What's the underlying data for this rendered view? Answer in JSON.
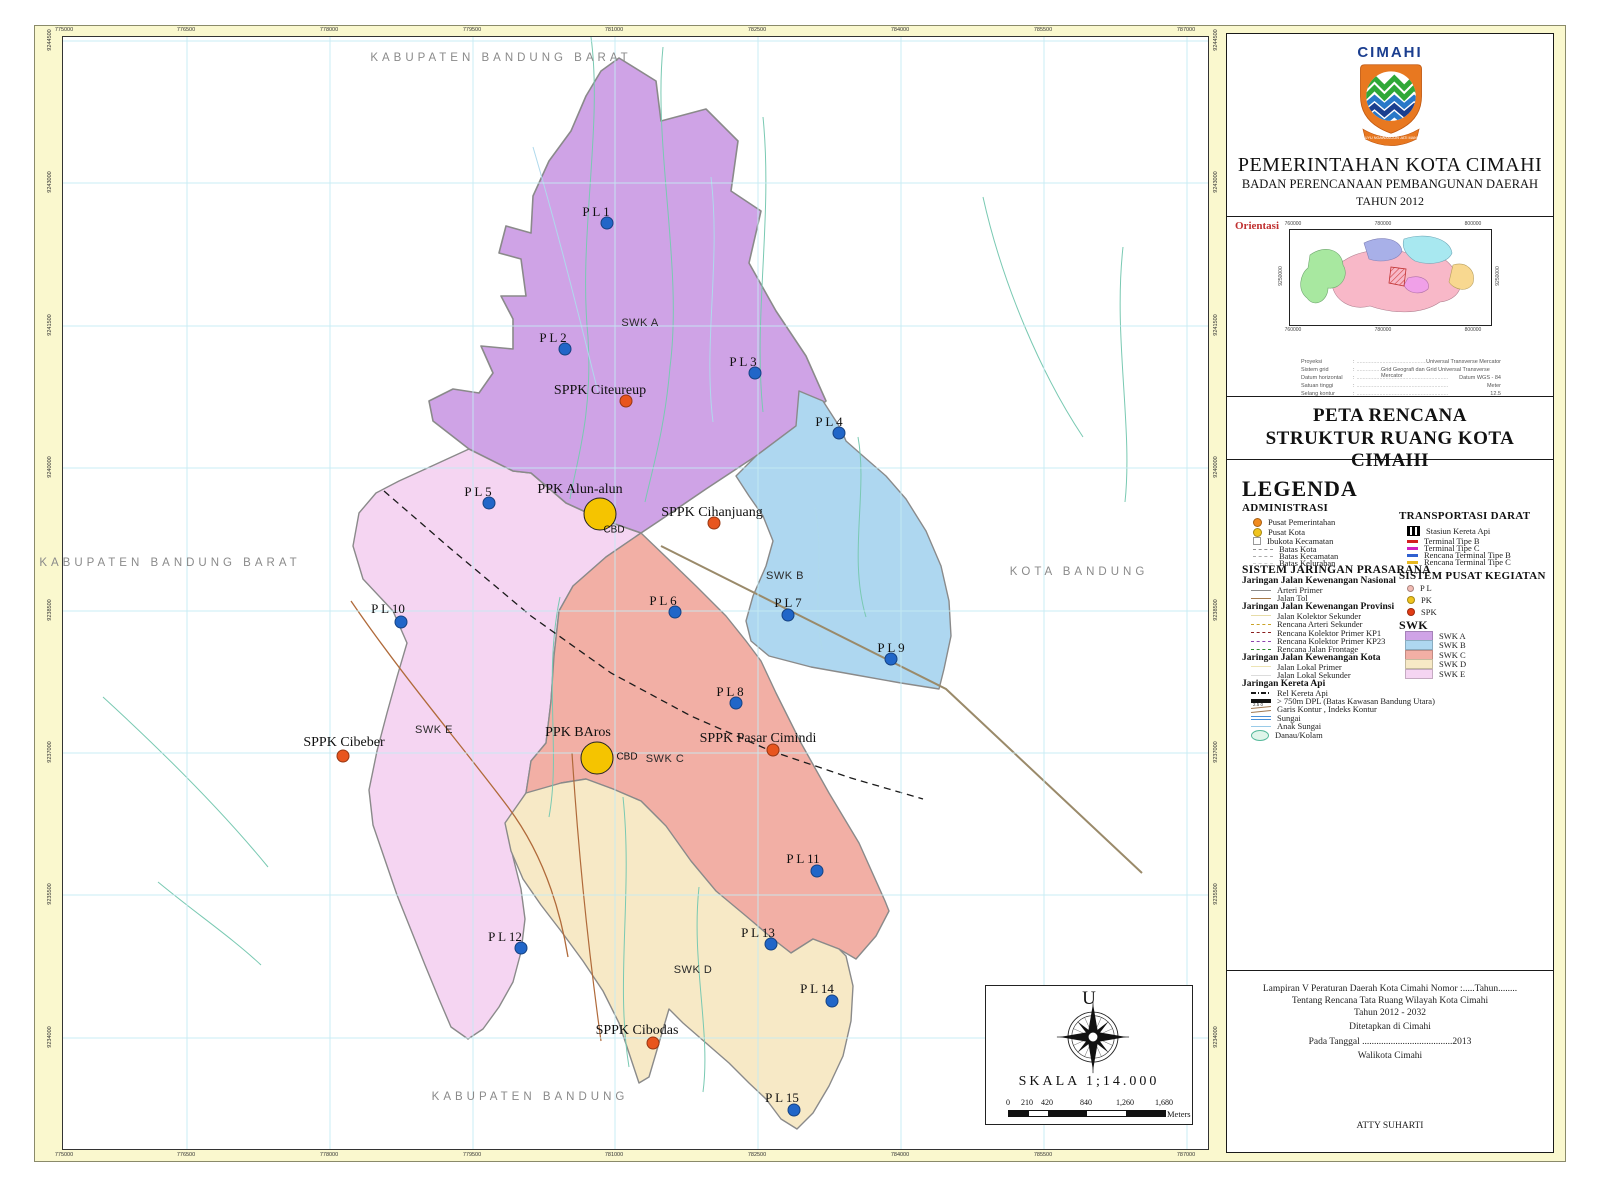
{
  "header": {
    "logo_text": "CIMAHI",
    "logo_motto": "SALUYU NGAWANGUN JATI MANDIRI",
    "agency_line1": "PEMERINTAHAN KOTA CIMAHI",
    "agency_line2": "BADAN PERENCANAAN PEMBANGUNAN DAERAH",
    "agency_line3": "TAHUN 2012"
  },
  "orientasi": {
    "label": "Orientasi",
    "grid_top": [
      "760000",
      "780000",
      "800000"
    ],
    "grid_side": "9250000",
    "projection_rows": [
      {
        "label": "Proyeksi",
        "value": "Universal Transverse Mercator"
      },
      {
        "label": "Sistem grid",
        "value": "Grid Geografi dan Grid Universal Transverse Mercator"
      },
      {
        "label": "Datum horizontal",
        "value": "Datum WGS - 84"
      },
      {
        "label": "Satuan tinggi",
        "value": "Meter"
      },
      {
        "label": "Selang kontur",
        "value": "12.5"
      }
    ]
  },
  "map_title": {
    "line1": "PETA RENCANA",
    "line2": "STRUKTUR RUANG KOTA CIMAHI"
  },
  "legend": {
    "title": "LEGENDA",
    "administrasi": {
      "title": "ADMINISTRASI",
      "items": [
        {
          "kind": "dot",
          "color": "#F08A1E",
          "size": 7,
          "label": "Pusat Pemerintahan"
        },
        {
          "kind": "dot",
          "color": "#F0C41E",
          "size": 7,
          "label": "Pusat Kota"
        },
        {
          "kind": "square",
          "color": "#FFFFFF",
          "border": "#999999",
          "label": "Ibukota Kecamatan"
        },
        {
          "kind": "dashline",
          "color": "#909090",
          "label": "Batas Kota"
        },
        {
          "kind": "dashline",
          "color": "#ABABAB",
          "label": "Batas Kecamatan"
        },
        {
          "kind": "dashline",
          "color": "#CFCFCF",
          "label": "Batas Kelurahan"
        }
      ]
    },
    "prasarana": {
      "title": "SISTEM JARINGAN PRASARANA",
      "groups": [
        {
          "title": "Jaringan Jalan Kewenangan Nasional",
          "items": [
            {
              "kind": "line",
              "color": "#8A8A8A",
              "label": "Arteri Primer"
            },
            {
              "kind": "line",
              "color": "#A5794A",
              "label": "Jalan Tol"
            }
          ]
        },
        {
          "title": "Jaringan Jalan Kewenangan Provinsi",
          "items": [
            {
              "kind": "line",
              "color": "#E7DCA8",
              "label": "Jalan Kolektor Sekunder"
            },
            {
              "kind": "dashline",
              "color": "#C9A227",
              "label": "Rencana Arteri Sekunder"
            },
            {
              "kind": "dashline",
              "color": "#8B1E1E",
              "label": "Rencana Kolektor Primer KP1"
            },
            {
              "kind": "dashline",
              "color": "#8E44AD",
              "label": "Rencana Kolektor Primer KP23"
            },
            {
              "kind": "dashline",
              "color": "#2E8B2E",
              "label": "Rencana Jalan Frontage"
            }
          ]
        },
        {
          "title": "Jaringan Jalan Kewenangan Kota",
          "items": [
            {
              "kind": "line",
              "color": "#EDE4B4",
              "label": "Jalan Lokal Primer"
            },
            {
              "kind": "line",
              "color": "#DCDCDC",
              "label": "Jalan Lokal Sekunder"
            }
          ]
        },
        {
          "title": "Jaringan Kereta Api",
          "items": [
            {
              "kind": "dashdot",
              "color": "#1A1A1A",
              "label": "Rel Kereta Api"
            },
            {
              "kind": "thickline",
              "color": "#111111",
              "label": "> 750m DPL (Batas Kawasan Bandung Utara)"
            },
            {
              "kind": "contour",
              "color": "#A07850",
              "label": "Garis Kontur , Indeks Kontur",
              "nums": [
                "2.5",
                "0"
              ]
            },
            {
              "kind": "river",
              "color": "#4A90D9",
              "label": "Sungai"
            },
            {
              "kind": "stream",
              "color": "#9ACBE8",
              "label": "Anak Sungai"
            },
            {
              "kind": "lake",
              "color": "#DFF5EA",
              "border": "#55B89A",
              "label": "Danau/Kolam"
            }
          ]
        }
      ]
    },
    "transportasi": {
      "title": "TRANSPORTASI DARAT",
      "items": [
        {
          "kind": "station",
          "label": "Stasiun Kereta Api"
        },
        {
          "kind": "dashbar",
          "color": "#D22020",
          "label": "Terminal Tipe B"
        },
        {
          "kind": "dashbar",
          "color": "#D020C0",
          "label": "Terminal Tipe C"
        },
        {
          "kind": "dashbar",
          "color": "#3060D0",
          "label": "Rencana Terminal Tipe B"
        },
        {
          "kind": "dashbar",
          "color": "#E8B81E",
          "label": "Rencana Terminal Tipe C"
        }
      ]
    },
    "pusat_kegiatan": {
      "title": "SISTEM PUSAT KEGIATAN",
      "items": [
        {
          "kind": "dot",
          "color": "#F2BCB4",
          "size": 5,
          "label": "P L"
        },
        {
          "kind": "dot",
          "color": "#F0C41E",
          "size": 6,
          "label": "PK"
        },
        {
          "kind": "dot",
          "color": "#E23C14",
          "size": 6,
          "label": "SPK"
        }
      ]
    },
    "swk": {
      "title": "SWK",
      "items": [
        {
          "label": "SWK A",
          "color": "#CFA3E6"
        },
        {
          "label": "SWK B",
          "color": "#AED7F0"
        },
        {
          "label": "SWK C",
          "color": "#F2AFA5"
        },
        {
          "label": "SWK D",
          "color": "#F7E9C6"
        },
        {
          "label": "SWK E",
          "color": "#F5D5F2"
        }
      ]
    }
  },
  "notes": {
    "lines": [
      "Lampiran V Peraturan Daerah Kota Cimahi Nomor :.....Tahun........",
      "Tentang Rencana Tata Ruang Wilayah Kota Cimahi",
      "Tahun 2012 - 2032",
      "Ditetapkan di Cimahi",
      "Pada Tanggal ......................................2013",
      "Walikota Cimahi",
      "ATTY SUHARTI"
    ],
    "ys": [
      950,
      962,
      974,
      988,
      1003,
      1017,
      1087
    ]
  },
  "scale": {
    "north": "U",
    "text": "SKALA 1;14.000",
    "ticks": [
      "0",
      "210",
      "420",
      "840",
      "1,260",
      "1,680"
    ],
    "tick_x": [
      22,
      41,
      61,
      100,
      139,
      178
    ],
    "unit": "Meters"
  },
  "map": {
    "zones": [
      {
        "id": "E",
        "name": "SWK E",
        "color": "#F5D5F2"
      },
      {
        "id": "A",
        "name": "SWK A",
        "color": "#CFA3E6"
      },
      {
        "id": "B",
        "name": "SWK B",
        "color": "#AED7F0"
      },
      {
        "id": "C",
        "name": "SWK C",
        "color": "#F2AFA5"
      },
      {
        "id": "D",
        "name": "SWK D",
        "color": "#F7E9C6"
      }
    ],
    "zone_labels": [
      {
        "label": "SWK A",
        "x": 640,
        "y": 323
      },
      {
        "label": "SWK B",
        "x": 785,
        "y": 576
      },
      {
        "label": "SWK C",
        "x": 665,
        "y": 759
      },
      {
        "label": "SWK D",
        "x": 693,
        "y": 970
      },
      {
        "label": "SWK E",
        "x": 434,
        "y": 730
      }
    ],
    "neighbors": [
      {
        "label": "KABUPATEN BANDUNG BARAT",
        "x": 501,
        "y": 58
      },
      {
        "label": "KABUPATEN BANDUNG BARAT",
        "x": 170,
        "y": 563
      },
      {
        "label": "KOTA BANDUNG",
        "x": 1079,
        "y": 572
      },
      {
        "label": "KABUPATEN BANDUNG",
        "x": 530,
        "y": 1097
      }
    ],
    "colors": {
      "pl_dot": "#2166C8",
      "sppk_dot": "#E8551E",
      "ppk_fill": "#F5C400"
    },
    "points": [
      {
        "t": "pl",
        "label": "P L 1",
        "lx": 596,
        "ly": 212,
        "dx": 607,
        "dy": 223
      },
      {
        "t": "pl",
        "label": "P L 2",
        "lx": 553,
        "ly": 338,
        "dx": 565,
        "dy": 349
      },
      {
        "t": "pl",
        "label": "P L 3",
        "lx": 743,
        "ly": 362,
        "dx": 755,
        "dy": 373
      },
      {
        "t": "pl",
        "label": "P L 4",
        "lx": 829,
        "ly": 422,
        "dx": 839,
        "dy": 433
      },
      {
        "t": "pl",
        "label": "P L 5",
        "lx": 478,
        "ly": 492,
        "dx": 489,
        "dy": 503
      },
      {
        "t": "pl",
        "label": "P L 6",
        "lx": 663,
        "ly": 601,
        "dx": 675,
        "dy": 612
      },
      {
        "t": "pl",
        "label": "P L 7",
        "lx": 788,
        "ly": 603,
        "dx": 788,
        "dy": 615
      },
      {
        "t": "pl",
        "label": "P L 8",
        "lx": 730,
        "ly": 692,
        "dx": 736,
        "dy": 703
      },
      {
        "t": "pl",
        "label": "P L 9",
        "lx": 891,
        "ly": 648,
        "dx": 891,
        "dy": 659
      },
      {
        "t": "pl",
        "label": "P L 10",
        "lx": 388,
        "ly": 609,
        "dx": 401,
        "dy": 622
      },
      {
        "t": "pl",
        "label": "P L 11",
        "lx": 803,
        "ly": 859,
        "dx": 817,
        "dy": 871
      },
      {
        "t": "pl",
        "label": "P L 12",
        "lx": 505,
        "ly": 937,
        "dx": 521,
        "dy": 948
      },
      {
        "t": "pl",
        "label": "P L 13",
        "lx": 758,
        "ly": 933,
        "dx": 771,
        "dy": 944
      },
      {
        "t": "pl",
        "label": "P L 14",
        "lx": 817,
        "ly": 989,
        "dx": 832,
        "dy": 1001
      },
      {
        "t": "pl",
        "label": "P L 15",
        "lx": 782,
        "ly": 1098,
        "dx": 794,
        "dy": 1110
      },
      {
        "t": "sppk",
        "label": "SPPK Citeureup",
        "lx": 600,
        "ly": 391,
        "dx": 626,
        "dy": 401
      },
      {
        "t": "sppk",
        "label": "SPPK Cihanjuang",
        "lx": 712,
        "ly": 513,
        "dx": 714,
        "dy": 523
      },
      {
        "t": "sppk",
        "label": "SPPK Cibeber",
        "lx": 344,
        "ly": 743,
        "dx": 343,
        "dy": 756
      },
      {
        "t": "sppk",
        "label": "SPPK Pasar Cimindi",
        "lx": 758,
        "ly": 739,
        "dx": 773,
        "dy": 750
      },
      {
        "t": "sppk",
        "label": "SPPK Cibodas",
        "lx": 637,
        "ly": 1031,
        "dx": 653,
        "dy": 1043
      }
    ],
    "ppk": [
      {
        "label": "PPK Alun-alun",
        "lx": 580,
        "ly": 490,
        "cx": 600,
        "cy": 514,
        "cbd": "CBD",
        "bx": 614,
        "by": 530
      },
      {
        "label": "PPK BAros",
        "lx": 578,
        "ly": 733,
        "cx": 597,
        "cy": 758,
        "cbd": "CBD",
        "bx": 627,
        "by": 757
      }
    ],
    "grid": {
      "eastings": [
        "775000",
        "776500",
        "778000",
        "779500",
        "781000",
        "782500",
        "784000",
        "785500",
        "787000"
      ],
      "eastings_x": [
        64,
        186,
        329,
        472,
        614,
        757,
        900,
        1043,
        1186
      ],
      "northings": [
        "9244500",
        "9243000",
        "9241500",
        "9240000",
        "9238500",
        "9237000",
        "9235500",
        "9234000"
      ],
      "northings_y": [
        40,
        182,
        325,
        467,
        610,
        752,
        894,
        1037
      ]
    }
  }
}
